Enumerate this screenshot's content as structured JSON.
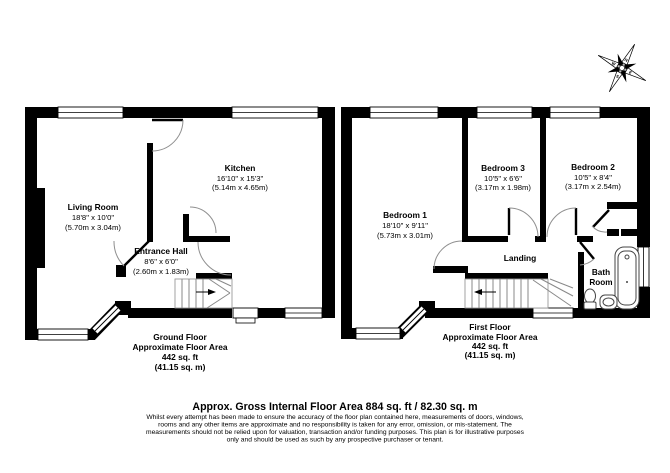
{
  "floorplan": {
    "ground_floor": {
      "rooms": {
        "living_room": {
          "name": "Living Room",
          "imperial": "18'8\" x 10'0\"",
          "metric": "(5.70m x 3.04m)"
        },
        "kitchen": {
          "name": "Kitchen",
          "imperial": "16'10\" x 15'3\"",
          "metric": "(5.14m x 4.65m)"
        },
        "entrance_hall": {
          "name": "Entrance Hall",
          "imperial": "8'6\" x 6'0\"",
          "metric": "(2.60m x 1.83m)"
        }
      },
      "summary": {
        "line1": "Ground Floor",
        "line2": "Approximate Floor Area",
        "line3": "442 sq. ft",
        "line4": "(41.15 sq. m)"
      }
    },
    "first_floor": {
      "rooms": {
        "bedroom_1": {
          "name": "Bedroom 1",
          "imperial": "18'10\" x 9'11\"",
          "metric": "(5.73m x 3.01m)"
        },
        "bedroom_3": {
          "name": "Bedroom 3",
          "imperial": "10'5\" x 6'6\"",
          "metric": "(3.17m x 1.98m)"
        },
        "bedroom_2": {
          "name": "Bedroom 2",
          "imperial": "10'5\" x 8'4\"",
          "metric": "(3.17m x 2.54m)"
        },
        "landing": {
          "name": "Landing"
        },
        "bathroom": {
          "line1": "Bath",
          "line2": "Room"
        }
      },
      "summary": {
        "line1": "First Floor",
        "line2": "Approximate Floor Area",
        "line3": "442 sq. ft",
        "line4": "(41.15 sq. m)"
      }
    },
    "compass": {
      "labels": [
        "N",
        "E",
        "S",
        "W"
      ]
    },
    "footer": {
      "title": "Approx. Gross Internal Floor Area 884 sq. ft / 82.30 sq. m",
      "disclaimer_lines": [
        "Whilst every attempt has been made to ensure the accuracy of the floor plan contained here, measurements of doors, windows,",
        "rooms and any other items are approximate and no responsibility is taken for any error, omission, or mis-statement. The",
        "measurements should not be relied upon for valuation, transaction and/or funding purposes. This plan is for illustrative purposes",
        "only and should be used as such by any prospective purchaser or tenant."
      ]
    },
    "colors": {
      "wall": "#000000",
      "background": "#ffffff",
      "thin_line": "#8f8f8f"
    }
  }
}
